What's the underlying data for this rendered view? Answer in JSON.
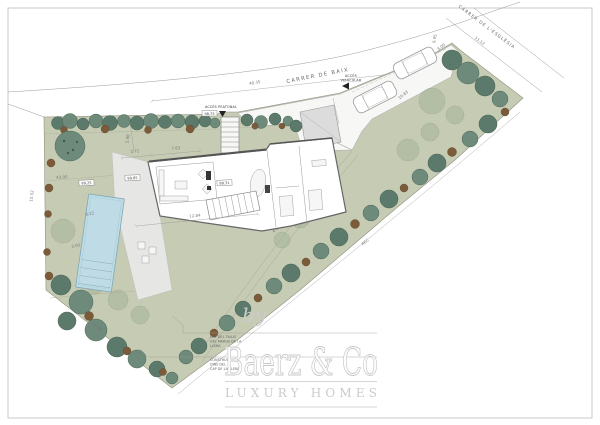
{
  "page": {
    "background": "#ffffff",
    "frame_color": "#c9c9c9"
  },
  "colors": {
    "garden_green": "#c6cbb4",
    "tree_dark_green": "#5c7a6b",
    "tree_light_green": "#9fb194",
    "shrub_brown": "#7c5b3a",
    "pool_blue": "#bfdce6",
    "terrace_grey": "#e6e6e4",
    "watermark_grey": "#cbcbcb"
  },
  "streets": {
    "top_label": "CARRER DE BAIX",
    "right_label": "CARRER DE L'ESGLÉSIA"
  },
  "access": {
    "pedestrian_label": "ACCÉS PEATONAL",
    "pedestrian_level": "98.75",
    "vehicular_label_1": "ACCÉS",
    "vehicular_label_2": "VEHICULAR"
  },
  "levels": {
    "terrace_west": "99.25",
    "house_west": "99.85",
    "house_east": "99.31"
  },
  "dimensions": {
    "street_frontage": "40.35",
    "church_frontage": "11.12",
    "west_boundary": "15.52",
    "southwest_boundary": "13.88",
    "garden_west": "43.00",
    "parking_edge": "10.83",
    "driveway_side": "3.64",
    "corner_a": "3.00",
    "corner_b": "0.95",
    "entry_side": "5.98",
    "house_top_a": "2.72",
    "house_top_b": "7.63",
    "house_south": "12.84",
    "path_a": "8.77",
    "path_b": "4.23",
    "pool_length": "8.22",
    "pool_width": "3.00"
  },
  "watercourse": {
    "label": "REC"
  },
  "legend": {
    "callout1": [
      "CAP DEL TALUS",
      "DEL MARGE DE LA",
      "LLERA"
    ],
    "callout2": [
      "CONSTRUCCIO",
      "DINS DEL",
      "CAP DE LA LLERA"
    ]
  },
  "watermark": {
    "prefix": "by",
    "brand": "Baerz & Co",
    "tagline": "LUXURY HOMES"
  }
}
